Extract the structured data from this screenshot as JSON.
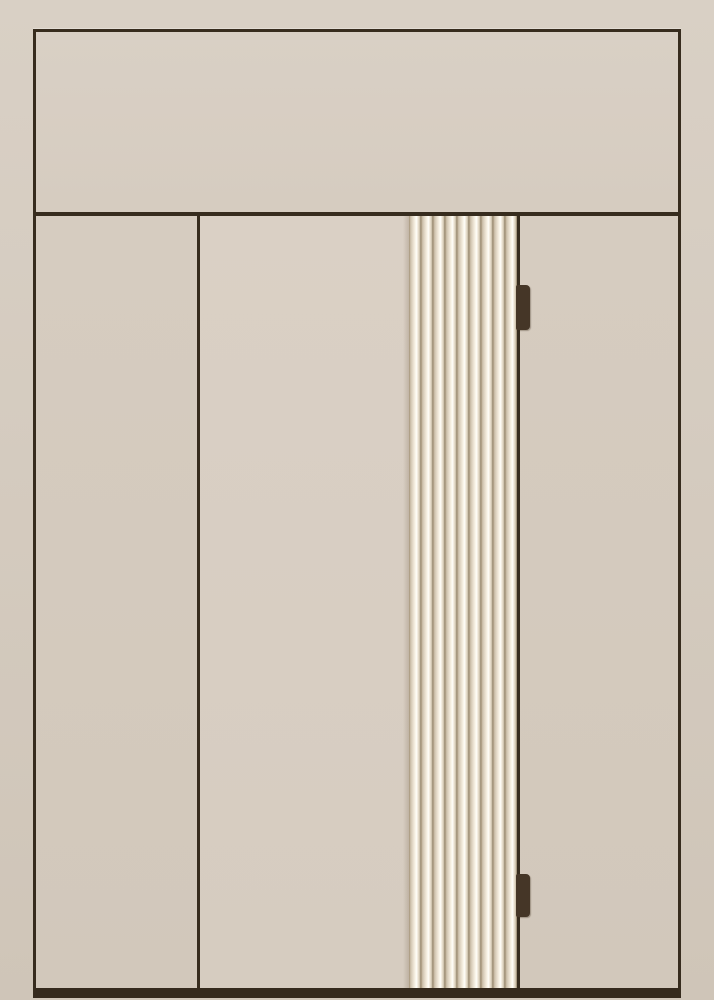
{
  "scene": {
    "subject": "entry-door-elevation",
    "text_content": "none"
  },
  "door": {
    "flute_count": 9,
    "hinge_count": 2,
    "hinges": [
      {
        "top": 285,
        "height": 45
      },
      {
        "top": 874,
        "height": 43
      }
    ],
    "sections": {
      "transom": "fixed top panel",
      "left": "sidelight",
      "center": "door leaf with fluted band",
      "right": "sidelight"
    }
  },
  "colors": {
    "bg_top": "#d9d0c5",
    "bg_bottom": "#cfc5b8",
    "frame_line": "#372c1e",
    "bottom_rail": "#352a1d",
    "panel": "#d6ccc0",
    "panel_transom": "#d9d0c5",
    "panel_center": "#dad0c5",
    "panel_dim": "#d2c8bb",
    "flute_edge_dark": "#a29177",
    "flute_mid": "#cfc3ae",
    "flute_light": "#ece3d3",
    "flute_bright": "#faf6ea",
    "flute_highlight": "#fffefa",
    "flute_shadow": "#8d7d64",
    "hinge": "#453627"
  }
}
